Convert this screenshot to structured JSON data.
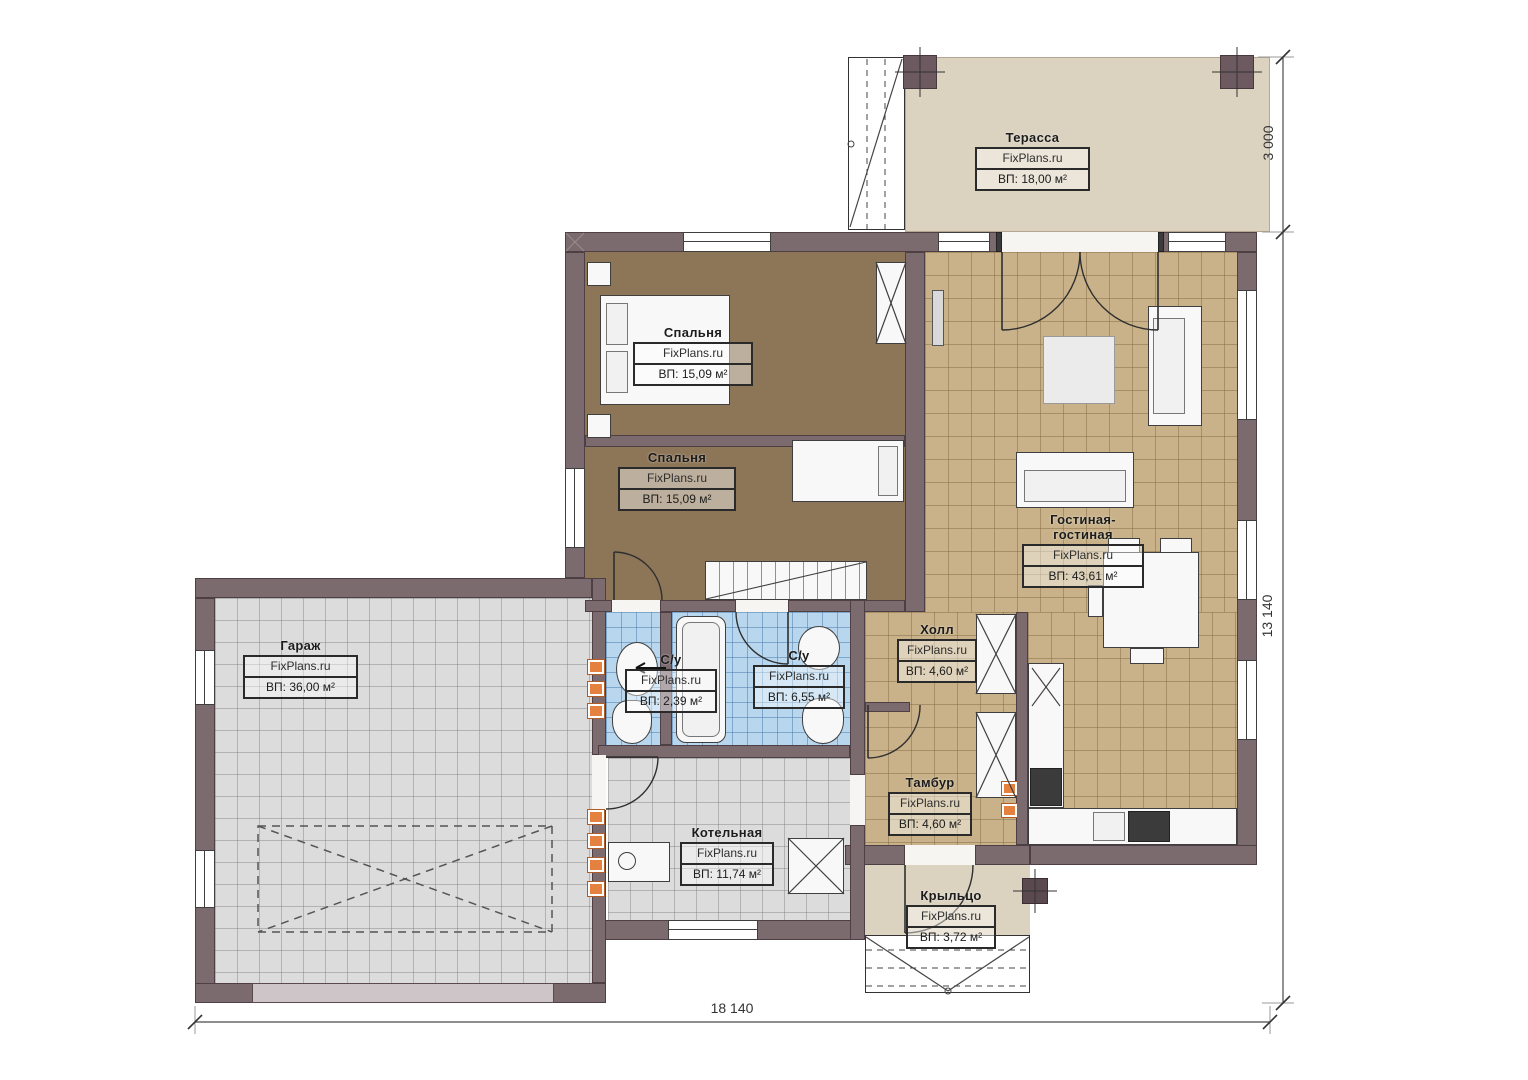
{
  "plan": {
    "brand": "FixPlans.ru",
    "rooms": [
      {
        "id": "terrace",
        "name": "Терасса",
        "watermark": "FixPlans.ru",
        "area": "ВП: 18,00 м²"
      },
      {
        "id": "bedroom-1",
        "name": "Спальня",
        "watermark": "FixPlans.ru",
        "area": "ВП: 15,09 м²"
      },
      {
        "id": "bedroom-2",
        "name": "Спальня",
        "watermark": "FixPlans.ru",
        "area": "ВП: 15,09 м²"
      },
      {
        "id": "living-room",
        "name": "Гостиная-гостиная",
        "watermark": "FixPlans.ru",
        "area": "ВП: 43,61 м²"
      },
      {
        "id": "garage",
        "name": "Гараж",
        "watermark": "FixPlans.ru",
        "area": "ВП: 36,00 м²"
      },
      {
        "id": "bathroom-small",
        "name": "С/у",
        "watermark": "FixPlans.ru",
        "area": "ВП: 2,39 м²"
      },
      {
        "id": "bathroom",
        "name": "С/у",
        "watermark": "FixPlans.ru",
        "area": "ВП: 6,55 м²"
      },
      {
        "id": "hall",
        "name": "Холл",
        "watermark": "FixPlans.ru",
        "area": "ВП: 4,60 м²"
      },
      {
        "id": "vestibule",
        "name": "Тамбур",
        "watermark": "FixPlans.ru",
        "area": "ВП: 4,60 м²"
      },
      {
        "id": "boiler-room",
        "name": "Котельная",
        "watermark": "FixPlans.ru",
        "area": "ВП: 11,74 м²"
      },
      {
        "id": "porch",
        "name": "Крыльцо",
        "watermark": "FixPlans.ru",
        "area": "ВП: 3,72 м²"
      }
    ],
    "dimensions": {
      "terrace_depth": "3 000",
      "house_height": "13 140",
      "house_width": "18 140"
    },
    "colors": {
      "wall": "#7b6a6e",
      "floor_tan": "#c9b289",
      "floor_brown": "#8d7557",
      "floor_blue": "#b8d7ee",
      "floor_gray": "#dcdcdc",
      "terrace": "#dcd2c0",
      "accent_orange": "#e5813f"
    }
  }
}
